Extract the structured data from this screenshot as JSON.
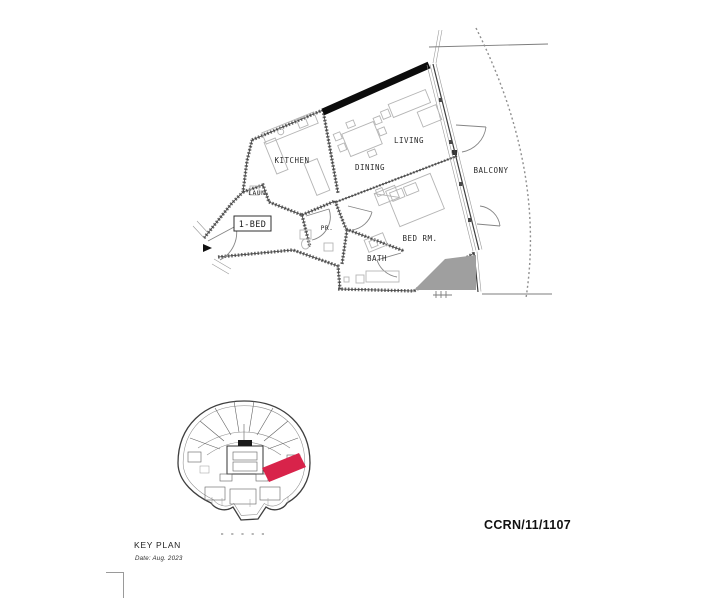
{
  "plan": {
    "unit_type_label": "1-BED",
    "rooms": {
      "kitchen": "KITCHEN",
      "dining": "DINING",
      "living": "LIVING",
      "balcony": "BALCONY",
      "laundry": "LAUN.",
      "powder": "PR.",
      "bath": "BATH",
      "bedroom": "BED RM."
    }
  },
  "key_plan": {
    "title": "KEY PLAN",
    "date_note": "Date: Aug. 2023"
  },
  "reference_number": "CCRN/11/1107",
  "colors": {
    "highlight": "#d8234a",
    "shade": "#9f9f9f",
    "party_wall": "#0c0c0c"
  }
}
